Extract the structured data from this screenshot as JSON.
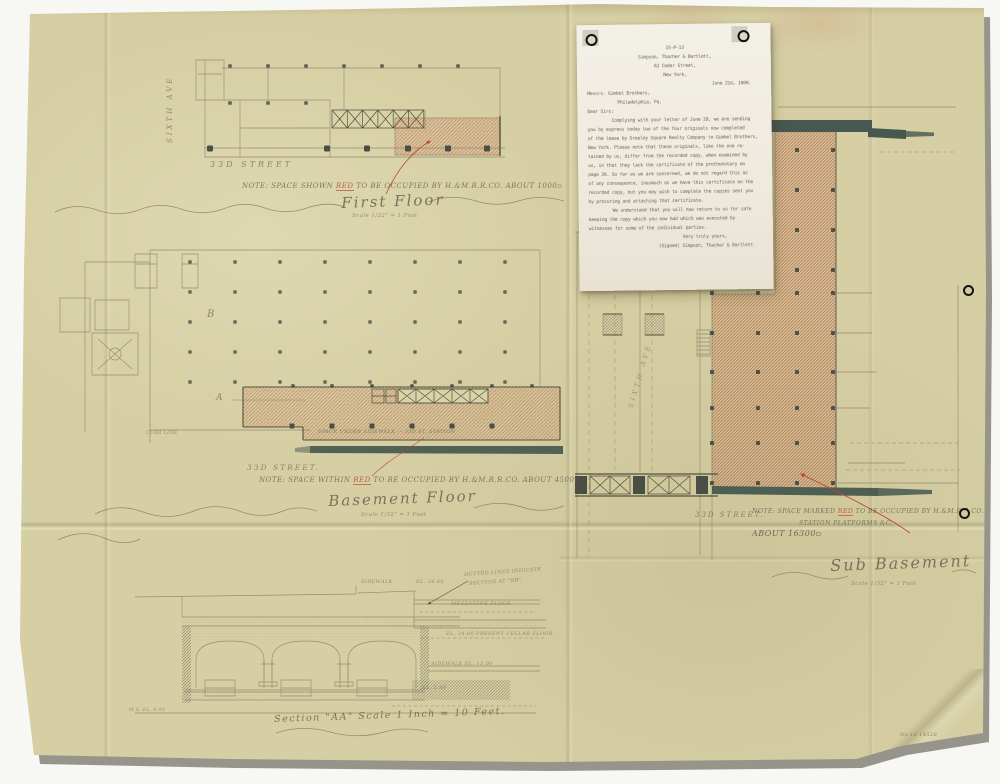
{
  "letter": {
    "doc_number": "15-P-13",
    "lines": [
      {
        "t": "15-P-13",
        "c": "c"
      },
      {
        "t": "Simpson, Thacher & Bartlett,",
        "c": "c"
      },
      {
        "t": "62 Cedar Street,",
        "c": "c"
      },
      {
        "t": "New York,",
        "c": "c"
      },
      {
        "t": "June 22d, 1909.",
        "c": "r"
      },
      {
        "t": "Messrs. Gimbel Brothers,",
        "c": "l"
      },
      {
        "t": "Philadelphia, Pa.",
        "c": "i2"
      },
      {
        "t": "Dear Sirs:",
        "c": "l"
      },
      {
        "t": "Complying with your letter of June 20, we are sending",
        "c": "i"
      },
      {
        "t": "you by express today two of the four originals now completed",
        "c": "l"
      },
      {
        "t": "of the lease by Greeley Square Realty Company to Gimbel Brothers,",
        "c": "l"
      },
      {
        "t": "New York. Please note that these originals, like the one re-",
        "c": "l"
      },
      {
        "t": "tained by us, differ from the recorded copy, when examined by",
        "c": "l"
      },
      {
        "t": "us, in that they lack the certificate of the prothonotary on",
        "c": "l"
      },
      {
        "t": "page 39. So far as we are concerned, we do not regard this as",
        "c": "l"
      },
      {
        "t": "of any consequence, inasmuch as we have this certificate on the",
        "c": "l"
      },
      {
        "t": "recorded copy, but you may wish to complete the copies sent you",
        "c": "l"
      },
      {
        "t": "by procuring and attaching that certificate.",
        "c": "l"
      },
      {
        "t": "We understand that you will now return to us for safe",
        "c": "i"
      },
      {
        "t": "keeping the copy which you now had which was executed by",
        "c": "l"
      },
      {
        "t": "witnesses for some of the individual parties.",
        "c": "l"
      },
      {
        "t": "Very truly yours,",
        "c": "y"
      },
      {
        "t": "(Signed) Simpson, Thacher & Bartlett",
        "c": "r"
      }
    ]
  },
  "plans": {
    "first_floor": {
      "avenue": "SIXTH AVE",
      "street": "33D STREET",
      "note_pre": "NOTE: SPACE SHOWN ",
      "note_red": "RED",
      "note_post": " TO BE OCCUPIED BY H.&M.R.R.CO. ABOUT 1000▫",
      "title": "First Floor",
      "scale": "Scale 1/32\" = 1 Foot"
    },
    "basement": {
      "label_a": "A",
      "label_b": "B",
      "curb": "CURB LINE",
      "hatch_label": "SPACE UNDER SIDEWALK — 33D ST. STATION",
      "street": "33D STREET.",
      "note_pre": "NOTE: SPACE WITHIN ",
      "note_red": "RED",
      "note_post": " TO BE OCCUPIED BY H.&M.R.R.CO. ABOUT 4500▫",
      "title": "Basement Floor",
      "scale": "Scale 1/32\" = 1 Foot"
    },
    "avenue": {
      "label": "SIXTH AVE"
    },
    "sub_basement": {
      "street_top": "STREET",
      "street": "33D STREET.",
      "note_pre": "NOTE: SPACE MARKED ",
      "note_red": "RED",
      "note_post": " TO BE OCCUPIED BY H.&M.R.R.CO.",
      "note_line2": "STATION PLATFORMS &C.",
      "note_line3": "ABOUT 16300▫",
      "title": "Sub Basement",
      "scale": "Scale 1/32\" = 1 Foot"
    }
  },
  "section": {
    "sidewalk": "SIDEWALK",
    "el_top": "EL. 34.60",
    "note1": "DOTTED LINES INDICATE",
    "note2": "SECTION AT \"BB\"",
    "mezzanine": "MEZZANINE FLOOR",
    "cellar": "EL. 24.00   PRESENT CELLAR FLOOR",
    "sidewalk2": "SIDEWALK   EL. 12.00",
    "el_low": "EL. 5.00",
    "datum": "M.S. EL. 0.00",
    "title": "Section \"AA\"  Scale 1 Inch = 10 Feet."
  },
  "corner_note": "No.16  14528",
  "colors": {
    "paper": "#d6cfa3",
    "pencil": "#6b6450",
    "red": "#c0452e",
    "teal": "#46584f",
    "hatch_red": "#b4573a"
  }
}
